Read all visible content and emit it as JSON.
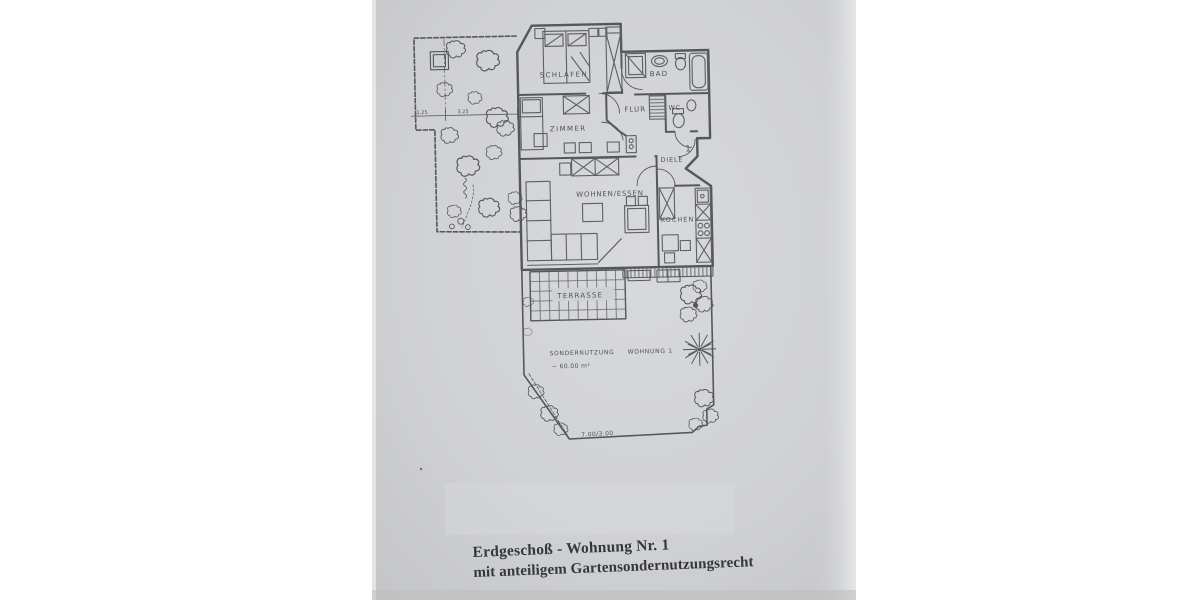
{
  "plan": {
    "rooms": {
      "schlafen": "SCHLAFEN",
      "zimmer": "ZIMMER",
      "bad": "BAD",
      "flur": "FLUR",
      "wc": "WC",
      "diele": "DIELE",
      "wohnen_essen": "WOHNEN/ESSEN",
      "kochen": "KOCHEN",
      "terrasse": "TERRASSE"
    },
    "garden": {
      "sondernutzung": "SONDERNUTZUNG",
      "wohnung": "WOHNUNG 1",
      "area": "~ 60.00 m²",
      "bottom_dimension": "7.00/3.00"
    },
    "dimensions": {
      "left": "1.25",
      "right": "3.25"
    },
    "entrance_number": "1"
  },
  "caption": {
    "line1": "Erdgeschoß - Wohnung Nr. 1",
    "line2": "mit anteiligem Gartensondernutzungsrecht"
  },
  "colors": {
    "background": "#ffffff",
    "paper": "#d0d1d3",
    "ink": "#4a4d53",
    "caption_ink": "#34373c"
  }
}
